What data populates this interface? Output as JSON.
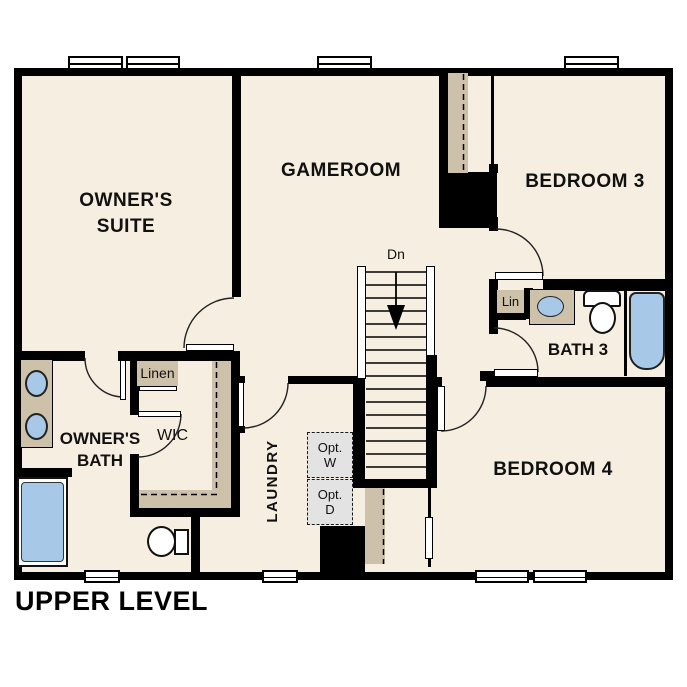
{
  "plan": {
    "title": "UPPER LEVEL",
    "rooms": {
      "owners_suite": {
        "line1": "OWNER'S",
        "line2": "SUITE"
      },
      "gameroom": {
        "label": "GAMEROOM"
      },
      "bedroom3": {
        "label": "BEDROOM 3"
      },
      "bedroom4": {
        "label": "BEDROOM 4"
      },
      "bath3": {
        "label": "BATH 3"
      },
      "owners_bath": {
        "line1": "OWNER'S",
        "line2": "BATH"
      },
      "wic": {
        "label": "WIC"
      },
      "laundry": {
        "label": "LAUNDRY"
      }
    },
    "closets": {
      "linen_label": "Linen",
      "lin_label": "Lin"
    },
    "stairs": {
      "down_label": "Dn"
    },
    "optional_appliances": {
      "washer": {
        "line1": "Opt.",
        "line2": "W"
      },
      "dryer": {
        "line1": "Opt.",
        "line2": "D"
      }
    },
    "colors": {
      "background": "#ffffff",
      "floor": "#f6eee1",
      "wall": "#000000",
      "casework_tan": "#cec1a9",
      "fixture_blue": "#a8c8e8",
      "optional_gray": "#e3e3e3"
    }
  }
}
